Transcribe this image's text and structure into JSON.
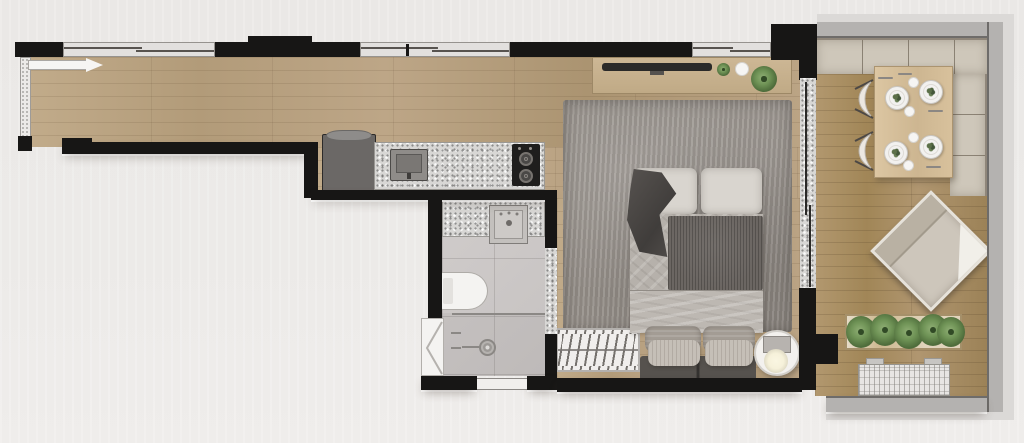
{
  "meta": {
    "type": "architectural-floor-plan",
    "description": "Top-down rendered floor plan of a studio apartment with entry corridor, linear kitchen, bathroom, combined bedroom-living area and furnished balcony",
    "visible_text": ""
  },
  "colors": {
    "exterior_bg": "#eae8e6",
    "wall_black": "#171615",
    "wood_floor": "#b7a07e",
    "wood_balcony": "#a98f6c",
    "granite_counter": "#d8d7d5",
    "bathroom_tile": "#cbc7c6",
    "rug_gray": "#97918b",
    "bed_sheet": "#b6b1ab",
    "bed_blanket": "#6b6662",
    "pillow_white": "#d9d5cf",
    "sofa_dark": "#56524e",
    "bench_beige": "#cec7ba",
    "parapet_gray": "#b4b2b0",
    "table_wood": "#d7c19d",
    "plant_green": "#6f8f58",
    "fridge_gray": "#6b6866",
    "appliance_black": "#1f1e1d",
    "white_fixture": "#f4f3f1",
    "lamp_glow": "#f6f1da",
    "window_sill": "#e2e0de"
  },
  "rooms": [
    {
      "name": "entry-corridor-kitchen",
      "floor": "wood",
      "features": [
        "entry-sliding-door",
        "windows",
        "refrigerator",
        "kitchen-counter",
        "kitchen-sink",
        "cooktop"
      ]
    },
    {
      "name": "bathroom",
      "floor": "tile",
      "features": [
        "vanity-counter",
        "vanity-sink",
        "toilet",
        "shower-glass-partition",
        "shower-drain",
        "bathroom-door"
      ]
    },
    {
      "name": "bedroom-living",
      "floor": "wood",
      "features": [
        "tv-console",
        "tv",
        "decor-plants",
        "area-rug",
        "double-bed",
        "throw-blanket",
        "foot-sofa",
        "slatted-rack",
        "round-side-table",
        "table-lamp",
        "window"
      ]
    },
    {
      "name": "balcony",
      "floor": "wood-deck",
      "features": [
        "l-shaped-bench",
        "dining-table",
        "four-place-settings",
        "two-dining-chairs",
        "lounge-chair",
        "planter-box",
        "ac-unit",
        "parapet-wall",
        "sliding-glass-door"
      ]
    }
  ]
}
